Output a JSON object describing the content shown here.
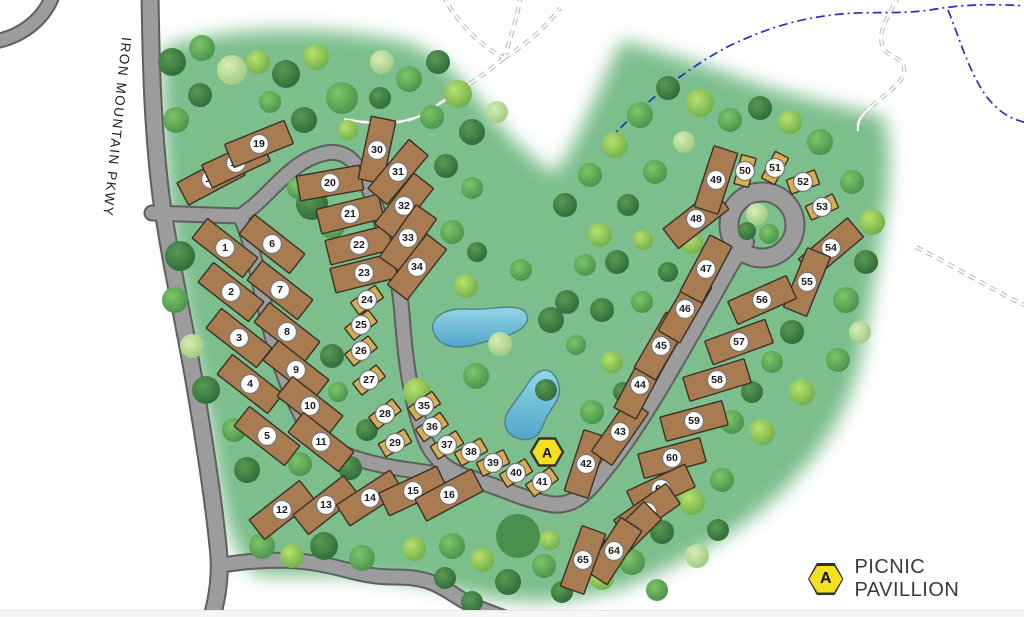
{
  "map": {
    "road_label": "IRON MOUNTAIN PKWY",
    "legend": {
      "symbol_letter": "A",
      "label": "PICNIC PAVILLION"
    },
    "marker": {
      "letter": "A",
      "x": 547,
      "y": 452
    },
    "colors": {
      "grass": "#7cbe8c",
      "road_fill": "#9c9c9c",
      "road_edge": "#5f5f5f",
      "site_standard": "#a87c50",
      "site_small": "#d8ae55",
      "site_outline": "#3a3127",
      "pond_light": "#93d6e6",
      "pond_dark": "#4fa5c9",
      "marker_yellow": "#f6e01d",
      "stream_blue": "#2a2ec4",
      "badge_fill": "#ffffff"
    },
    "sites": [
      {
        "n": 1,
        "x": 225,
        "y": 248,
        "angle": 38,
        "type": "standard"
      },
      {
        "n": 2,
        "x": 231,
        "y": 292,
        "angle": 38,
        "type": "standard"
      },
      {
        "n": 3,
        "x": 239,
        "y": 338,
        "angle": 38,
        "type": "standard"
      },
      {
        "n": 4,
        "x": 250,
        "y": 384,
        "angle": 38,
        "type": "standard"
      },
      {
        "n": 5,
        "x": 267,
        "y": 436,
        "angle": 38,
        "type": "standard"
      },
      {
        "n": 6,
        "x": 272,
        "y": 244,
        "angle": 38,
        "type": "standard"
      },
      {
        "n": 7,
        "x": 280,
        "y": 290,
        "angle": 38,
        "type": "standard"
      },
      {
        "n": 8,
        "x": 287,
        "y": 332,
        "angle": 38,
        "type": "standard"
      },
      {
        "n": 9,
        "x": 296,
        "y": 370,
        "angle": 38,
        "type": "standard"
      },
      {
        "n": 10,
        "x": 310,
        "y": 406,
        "angle": 38,
        "type": "standard"
      },
      {
        "n": 11,
        "x": 321,
        "y": 442,
        "angle": 38,
        "type": "standard"
      },
      {
        "n": 12,
        "x": 282,
        "y": 510,
        "angle": -38,
        "type": "standard"
      },
      {
        "n": 13,
        "x": 326,
        "y": 505,
        "angle": -38,
        "type": "standard"
      },
      {
        "n": 14,
        "x": 370,
        "y": 498,
        "angle": -33,
        "type": "standard"
      },
      {
        "n": 15,
        "x": 413,
        "y": 491,
        "angle": -25,
        "type": "standard"
      },
      {
        "n": 16,
        "x": 449,
        "y": 495,
        "angle": -28,
        "type": "standard"
      },
      {
        "n": 17,
        "x": 211,
        "y": 179,
        "angle": -28,
        "type": "standard"
      },
      {
        "n": 18,
        "x": 236,
        "y": 163,
        "angle": -25,
        "type": "standard"
      },
      {
        "n": 19,
        "x": 259,
        "y": 144,
        "angle": -22,
        "type": "standard"
      },
      {
        "n": 20,
        "x": 330,
        "y": 183,
        "angle": -10,
        "type": "standard"
      },
      {
        "n": 21,
        "x": 350,
        "y": 214,
        "angle": -14,
        "type": "standard"
      },
      {
        "n": 22,
        "x": 359,
        "y": 245,
        "angle": -14,
        "type": "standard"
      },
      {
        "n": 23,
        "x": 364,
        "y": 273,
        "angle": -14,
        "type": "standard"
      },
      {
        "n": 24,
        "x": 367,
        "y": 300,
        "angle": -35,
        "type": "small"
      },
      {
        "n": 25,
        "x": 361,
        "y": 325,
        "angle": -38,
        "type": "small"
      },
      {
        "n": 26,
        "x": 361,
        "y": 351,
        "angle": -38,
        "type": "small"
      },
      {
        "n": 27,
        "x": 369,
        "y": 380,
        "angle": -38,
        "type": "small"
      },
      {
        "n": 28,
        "x": 385,
        "y": 414,
        "angle": -38,
        "type": "small"
      },
      {
        "n": 29,
        "x": 395,
        "y": 443,
        "angle": -30,
        "type": "small"
      },
      {
        "n": 30,
        "x": 377,
        "y": 150,
        "angle": -78,
        "type": "standard"
      },
      {
        "n": 31,
        "x": 398,
        "y": 172,
        "angle": -50,
        "type": "standard"
      },
      {
        "n": 32,
        "x": 404,
        "y": 206,
        "angle": -52,
        "type": "standard"
      },
      {
        "n": 33,
        "x": 408,
        "y": 238,
        "angle": -55,
        "type": "standard"
      },
      {
        "n": 34,
        "x": 417,
        "y": 267,
        "angle": -52,
        "type": "standard"
      },
      {
        "n": 35,
        "x": 424,
        "y": 406,
        "angle": -35,
        "type": "small"
      },
      {
        "n": 36,
        "x": 432,
        "y": 427,
        "angle": -35,
        "type": "small"
      },
      {
        "n": 37,
        "x": 447,
        "y": 445,
        "angle": -32,
        "type": "small"
      },
      {
        "n": 38,
        "x": 471,
        "y": 452,
        "angle": -30,
        "type": "small"
      },
      {
        "n": 39,
        "x": 493,
        "y": 463,
        "angle": -26,
        "type": "small"
      },
      {
        "n": 40,
        "x": 516,
        "y": 473,
        "angle": -32,
        "type": "small"
      },
      {
        "n": 41,
        "x": 542,
        "y": 482,
        "angle": -36,
        "type": "small"
      },
      {
        "n": 42,
        "x": 586,
        "y": 464,
        "angle": -72,
        "type": "standard"
      },
      {
        "n": 43,
        "x": 620,
        "y": 432,
        "angle": -55,
        "type": "standard"
      },
      {
        "n": 44,
        "x": 640,
        "y": 385,
        "angle": -62,
        "type": "standard"
      },
      {
        "n": 45,
        "x": 661,
        "y": 346,
        "angle": -60,
        "type": "standard"
      },
      {
        "n": 46,
        "x": 685,
        "y": 309,
        "angle": -60,
        "type": "standard"
      },
      {
        "n": 47,
        "x": 706,
        "y": 269,
        "angle": -62,
        "type": "standard"
      },
      {
        "n": 48,
        "x": 696,
        "y": 219,
        "angle": -38,
        "type": "standard"
      },
      {
        "n": 49,
        "x": 716,
        "y": 180,
        "angle": -72,
        "type": "standard"
      },
      {
        "n": 50,
        "x": 745,
        "y": 171,
        "angle": -75,
        "type": "small"
      },
      {
        "n": 51,
        "x": 775,
        "y": 168,
        "angle": -62,
        "type": "small"
      },
      {
        "n": 52,
        "x": 803,
        "y": 182,
        "angle": -20,
        "type": "small"
      },
      {
        "n": 53,
        "x": 822,
        "y": 207,
        "angle": -25,
        "type": "small"
      },
      {
        "n": 54,
        "x": 831,
        "y": 248,
        "angle": -40,
        "type": "standard"
      },
      {
        "n": 55,
        "x": 807,
        "y": 282,
        "angle": -68,
        "type": "standard"
      },
      {
        "n": 56,
        "x": 762,
        "y": 300,
        "angle": -24,
        "type": "standard"
      },
      {
        "n": 57,
        "x": 739,
        "y": 342,
        "angle": -20,
        "type": "standard"
      },
      {
        "n": 58,
        "x": 717,
        "y": 380,
        "angle": -17,
        "type": "standard"
      },
      {
        "n": 59,
        "x": 694,
        "y": 421,
        "angle": -15,
        "type": "standard"
      },
      {
        "n": 60,
        "x": 672,
        "y": 458,
        "angle": -15,
        "type": "standard"
      },
      {
        "n": 61,
        "x": 661,
        "y": 489,
        "angle": -25,
        "type": "standard"
      },
      {
        "n": 62,
        "x": 647,
        "y": 512,
        "angle": -35,
        "type": "standard"
      },
      {
        "n": 63,
        "x": 630,
        "y": 533,
        "angle": -45,
        "type": "standard"
      },
      {
        "n": 64,
        "x": 614,
        "y": 551,
        "angle": -57,
        "type": "standard"
      },
      {
        "n": 65,
        "x": 583,
        "y": 560,
        "angle": -70,
        "type": "standard"
      }
    ]
  }
}
